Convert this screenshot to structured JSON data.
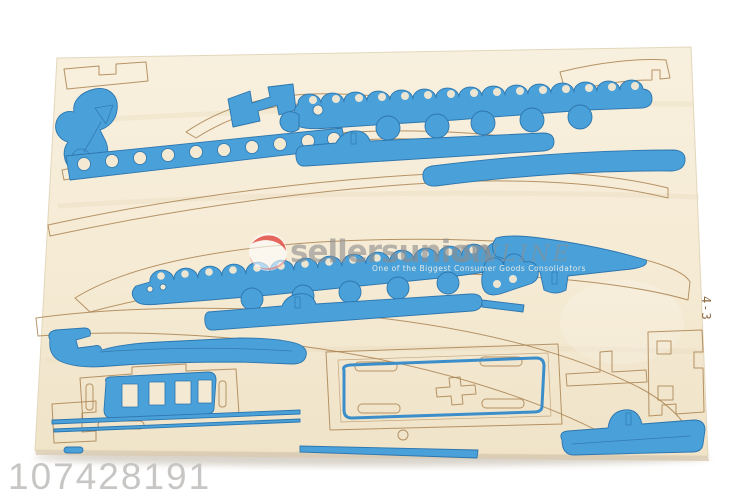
{
  "meta": {
    "description": "Product photo of a wooden 3D-puzzle sheet (boat model kit) with blue printed die-cut pieces on plywood",
    "product_id": "107428191",
    "sheet_label": "4-3"
  },
  "watermark": {
    "brand": "sellersunion",
    "suffix": "ONLINE",
    "subtext": "One of the Biggest Consumer Goods Consolidators"
  },
  "colors": {
    "photo_background": "#ffffff",
    "board_wood": "#f6ecd6",
    "board_wood_deep": "#eee0c2",
    "cut_line": "#aa8251",
    "print_blue": "#4aa0d8",
    "print_blue_dark": "#2e76ae",
    "watermark_gray": "#8d8d8d",
    "product_id_gray": "#c7c6c4",
    "shadow": "#b9b0a0"
  },
  "board": {
    "pieces_painted": [
      "arrow-pennant",
      "zigzag-bracket",
      "upper-wave-gunwale",
      "porthole-strip",
      "upper-stringer",
      "side-stringer",
      "lower-wave-gunwale",
      "lower-stringer",
      "rudder-arm",
      "wave-end-cap",
      "keel-wrench",
      "cabin-window-panel",
      "thin-stringers",
      "deck-plate",
      "bottom-hull-pad"
    ],
    "pieces_unpainted_outlines": 12,
    "porthole_counts": {
      "upper_gunwale": 5,
      "porthole_strip": 10,
      "lower_gunwale": 5
    },
    "window_count": 4
  }
}
